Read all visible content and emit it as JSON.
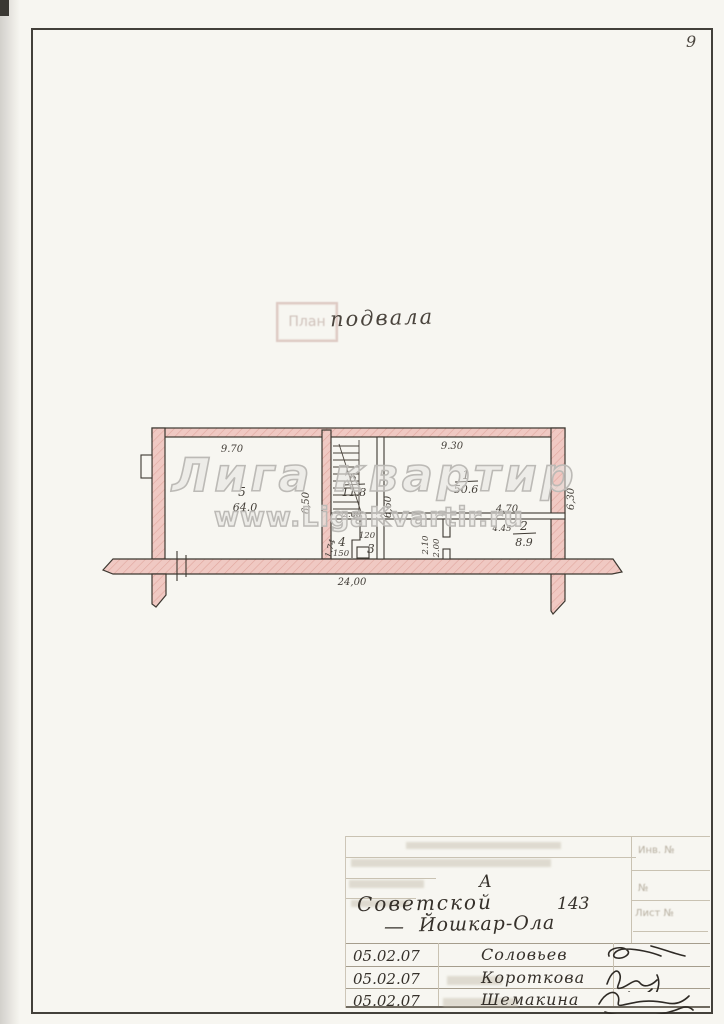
{
  "page": {
    "sheet_number": "9"
  },
  "title": {
    "stamp": "План",
    "handwritten": "подвала"
  },
  "watermark": {
    "line1": "Лига квартир",
    "line2": "www.LigaKvartir.ru"
  },
  "plan": {
    "rooms": {
      "r5": {
        "num": "5",
        "area": "64.0"
      },
      "r6": {
        "num": "6",
        "area": "11.8"
      },
      "r1": {
        "num": "1",
        "area": "50.6"
      },
      "r2": {
        "num": "2",
        "area": "8.9"
      },
      "r4": {
        "num": "4"
      },
      "r3": {
        "num": "3"
      }
    },
    "dims": {
      "top_left": "9.70",
      "top_right": "9.30",
      "overall": "24,00",
      "stair_left": "6,50",
      "stair_right": "6,60",
      "under_stair": "2.60",
      "r4_width": "150",
      "r4_depth": "1.74",
      "r3_width": "120",
      "r2_top": "4.70",
      "r2_inner": "4.45",
      "r2_left_a": "2.10",
      "r2_left_b": "2.00",
      "right_outer": "6,30"
    }
  },
  "title_block": {
    "letter": "А",
    "street": "Советской",
    "house_number": "143",
    "city_dash": "—",
    "city": "Йошкар-Ола",
    "faded_labels": {
      "inv": "Инв. №",
      "num": "№",
      "sheet": "Лист №"
    },
    "signature_rows": [
      {
        "date": "05.02.07",
        "name": "Соловьев"
      },
      {
        "date": "05.02.07",
        "name": "Короткова"
      },
      {
        "date": "05.02.07",
        "name": "Шемакина"
      }
    ]
  }
}
